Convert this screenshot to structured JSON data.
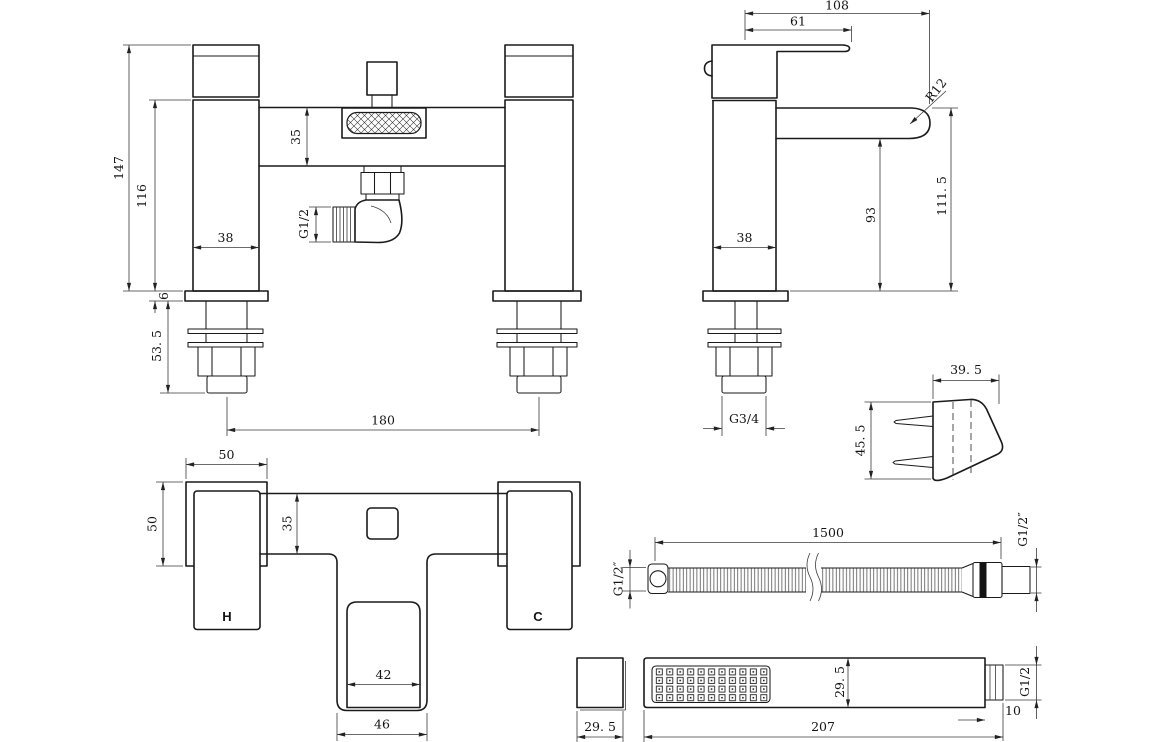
{
  "colors": {
    "line": "#1a1a1a",
    "dimension": "#3a3a3a",
    "background": "#ffffff"
  },
  "views": {
    "front": {
      "dims": {
        "total_height": "147",
        "body_height": "116",
        "bar_height": "35",
        "outlet_thread": "G1/2",
        "pillar_width": "38",
        "base_thickness": "6",
        "tail_length": "53. 5",
        "centres": "180"
      }
    },
    "side": {
      "dims": {
        "total_depth": "108",
        "handle_reach": "61",
        "spout_radius": "R12",
        "height_spout_top": "111. 5",
        "height_spout_under": "93",
        "body_depth": "38",
        "tail_thread": "G3/4"
      }
    },
    "bracket": {
      "dims": {
        "depth": "39. 5",
        "height": "45. 5"
      }
    },
    "plan": {
      "dims": {
        "handle_width": "50",
        "handle_depth": "50",
        "body_width": "35",
        "spout_inner_width": "42",
        "spout_outer_width": "46"
      },
      "labels": {
        "hot": "H",
        "cold": "C"
      }
    },
    "hose": {
      "dims": {
        "length": "1500",
        "left_thread": "G1/2″",
        "right_thread": "G1/2″"
      }
    },
    "handset": {
      "dims": {
        "face_size": "29. 5",
        "body_size": "29. 5",
        "length": "207",
        "thread_length": "10",
        "thread": "G1/2"
      }
    }
  }
}
